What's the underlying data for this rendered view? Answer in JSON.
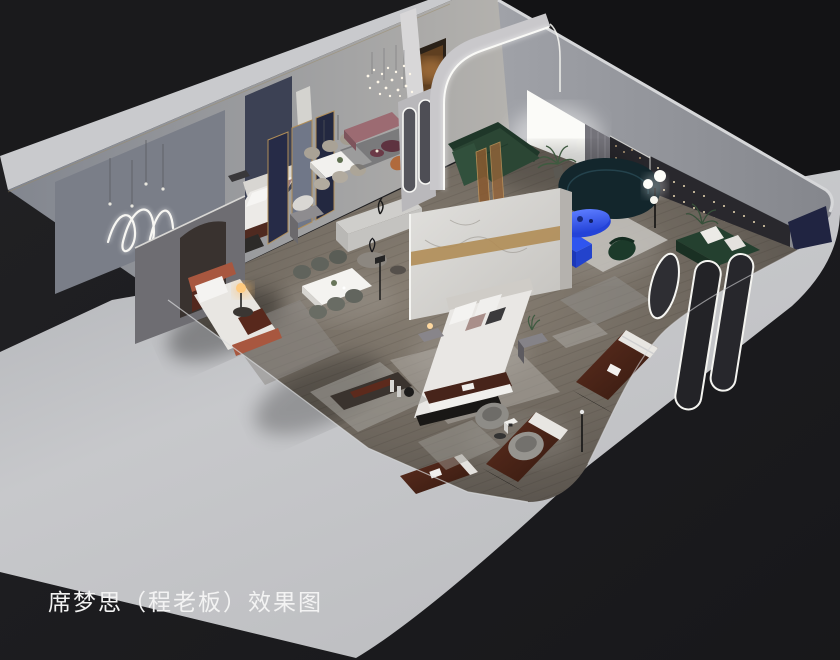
{
  "caption": {
    "text": "席梦思（程老板）效果图"
  },
  "scene": {
    "type": "3d-isometric-interior-rendering",
    "subject": "Simmons mattress showroom cutaway effect rendering",
    "areas": [
      "back-wall-gallery-with-neon-squiggle",
      "bedroom-display-orange-bed",
      "bedroom-display-white-bed",
      "dining-display-one",
      "dining-display-two",
      "marble-feature-bedroom",
      "arched-living-lounge",
      "dark-feature-wall-lounge",
      "mattress-display-row",
      "lounge-chair-corner"
    ]
  },
  "objects": [
    "outer-shell-walls",
    "wood-floor",
    "neon-squiggle-light",
    "pendant-cluster-chandelier",
    "white-bed-display",
    "orange-bed-display",
    "marble-partition-wall",
    "center-bed-display",
    "dining-table-set-1",
    "dining-table-set-2",
    "gold-frame-screens",
    "sideboard-cabinet",
    "pink-bench",
    "arched-led-wall",
    "pill-mirror-partition",
    "green-sectional-sofa",
    "amber-glass-screen",
    "teal-curved-sofa",
    "blue-coffee-table",
    "blue-tv-cabinet",
    "sphere-floor-lamp",
    "string-light-wall",
    "navy-accent-panel",
    "green-daybed",
    "arched-standing-mirrors",
    "oval-mirror",
    "mattress-display-1",
    "mattress-display-2",
    "mattress-display-3",
    "barrel-lounge-chairs",
    "brand-logo-cube",
    "low-display-bench"
  ],
  "colors": {
    "background": "#1c1c1e",
    "background_dark": "#131315",
    "shell_light": "#c4c5c8",
    "wall_strip": "#c9cacd",
    "wall_face_left": "#8b8f98",
    "wall_face_right": "#94969c",
    "floor_mid": "#6d665d",
    "accent_blue": "#2f55ef",
    "accent_blue_deep": "#1c38b8",
    "sofa_green": "#2b4634",
    "sofa_teal": "#13262c",
    "mattress_maroon": "#47241a",
    "gold": "#b08d57",
    "navy_panel": "#202441",
    "pink_bench": "#9c6b72",
    "orange_bed": "#a8573f",
    "glow_panel": "#fbfbf8",
    "led_white": "#f8f8f4",
    "caption_color": "#f3f3f3"
  }
}
